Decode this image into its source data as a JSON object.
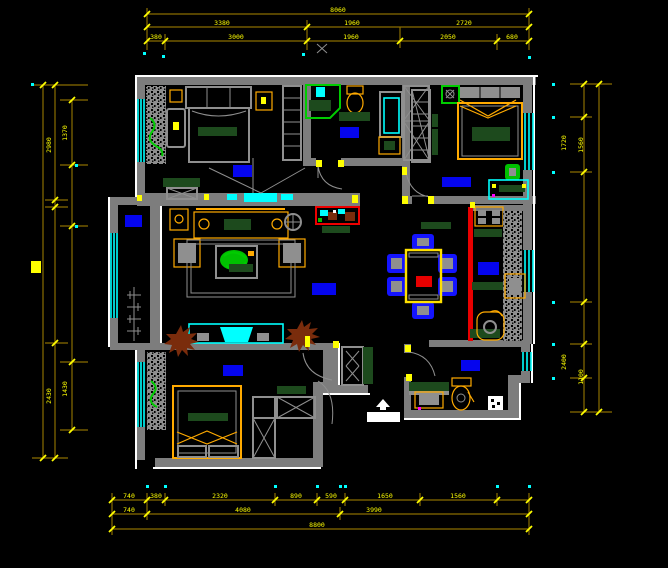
{
  "app": {
    "name": "cad-floor-plan-view",
    "background": "#000000"
  },
  "colors": {
    "wall": "#7d7d7d",
    "window": "#00ffff",
    "dimension_line": "#8a6d00",
    "dimension_text": "#ffff00",
    "furniture_accent": "#ffaa00",
    "room_label_block": "#0505ee",
    "kitchen_slide_door": "#ee0000",
    "plant_green": "#00cc00",
    "textile_green": "#1d4a1d"
  },
  "dims": {
    "top1": [
      "8060"
    ],
    "top2": [
      "3380",
      "1960",
      "2720"
    ],
    "top3": [
      "380",
      "3000",
      "1960",
      "2050",
      "680"
    ],
    "bottom1": [
      "740",
      "380",
      "2320",
      "890",
      "590",
      "1650",
      "1560"
    ],
    "bottom2": [
      "740",
      "4080",
      "3990"
    ],
    "bottom3": [
      "8800"
    ],
    "left": [
      "2980",
      "1370",
      "2430",
      "1430"
    ],
    "right": [
      "1720",
      "1560",
      "2400",
      "1100"
    ]
  }
}
